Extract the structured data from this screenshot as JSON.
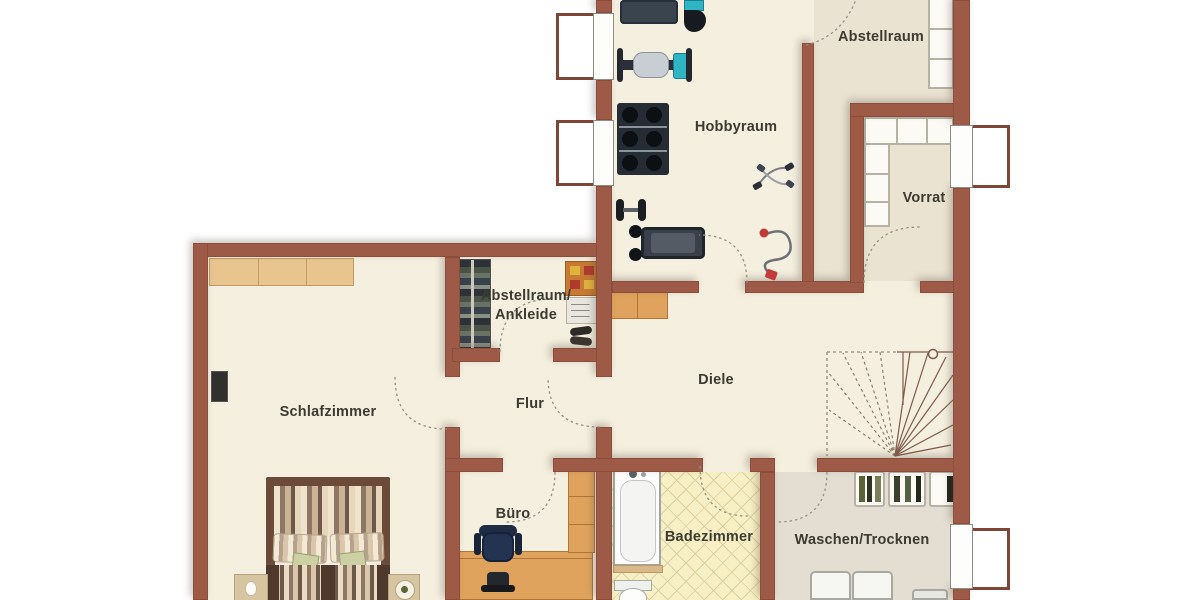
{
  "floorplan": {
    "type": "residential-basement-floor-plan",
    "rooms": {
      "abstellraum_top": {
        "label": "Abstellraum"
      },
      "hobbyraum": {
        "label": "Hobbyraum"
      },
      "vorrat": {
        "label": "Vorrat"
      },
      "ankleide": {
        "label_line1": "Abstellraum/",
        "label_line2": "Ankleide"
      },
      "schlafzimmer": {
        "label": "Schlafzimmer"
      },
      "flur": {
        "label": "Flur"
      },
      "diele": {
        "label": "Diele"
      },
      "buero": {
        "label": "Büro"
      },
      "badezimmer": {
        "label": "Badezimmer"
      },
      "waschen_trocknen": {
        "label": "Waschen/Trocknen"
      }
    },
    "colors": {
      "wall": "#9d5a47",
      "floor": "#f5efdf",
      "floor_storage": "#eae3d2",
      "floor_laundry": "#e3ded1",
      "floor_bath": "#f7f0c5",
      "wood": "#dfa35e",
      "accent_cyan": "#2fb4c4",
      "accent_red": "#c23b3b",
      "label_text": "#3c3b31"
    },
    "furniture_icons": [
      "multi-gym-machine",
      "weight-bench",
      "dumbbell-rack",
      "barbell",
      "treadmill",
      "jump-rope",
      "resistance-band",
      "storage-shelf",
      "storage-shelf-l",
      "window-light-well",
      "wardrobe-rack",
      "dresser",
      "radiator",
      "shoes",
      "sideboard",
      "wall-tv",
      "double-bed",
      "nightstand",
      "desk",
      "office-chair",
      "cabinet",
      "bathtub",
      "toilet",
      "winder-stairs",
      "drying-rack",
      "washing-machine",
      "laundry-basket",
      "door-swing"
    ]
  }
}
